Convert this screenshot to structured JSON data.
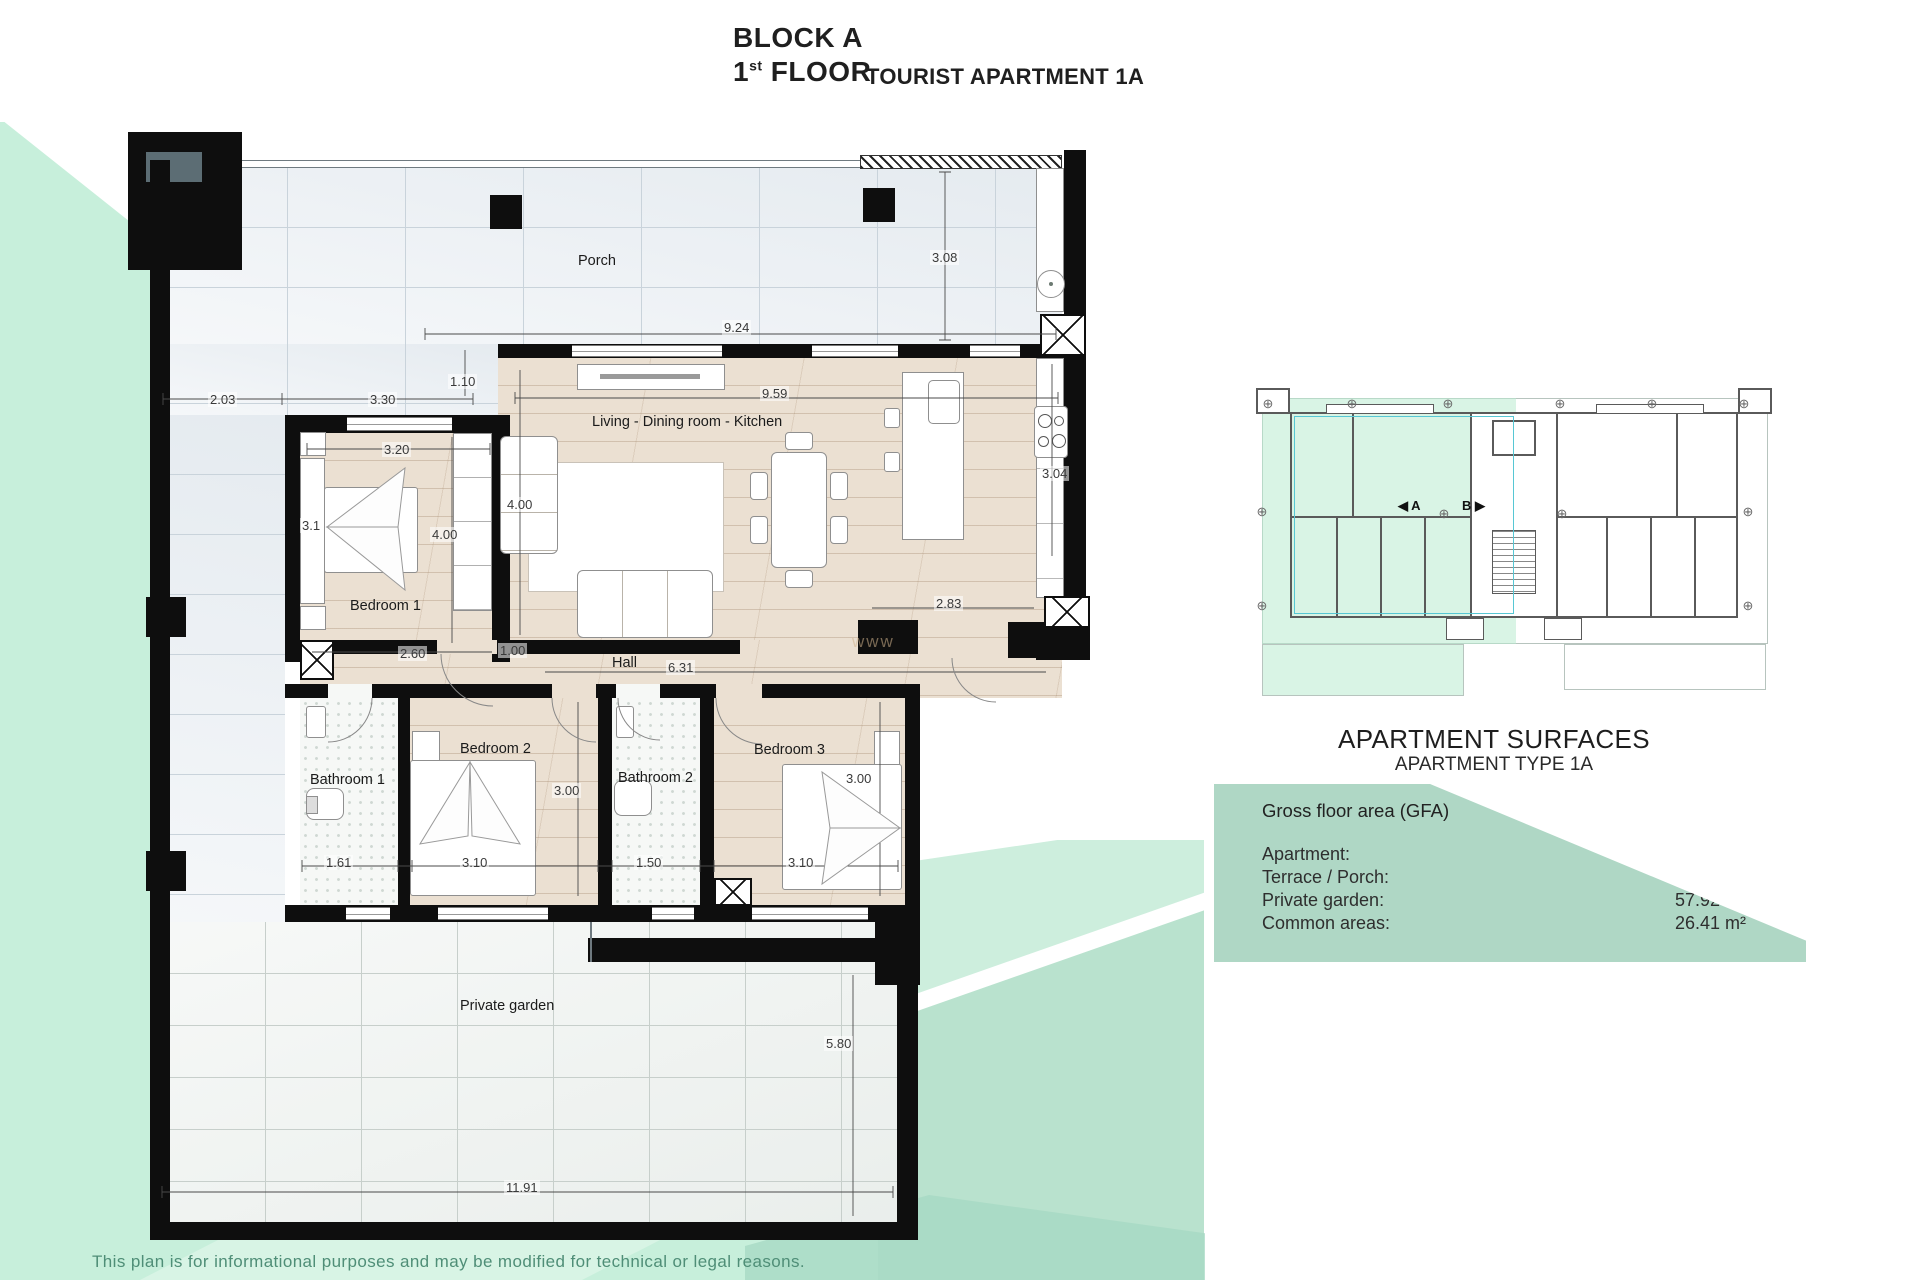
{
  "title": {
    "block": "BLOCK A",
    "floor_num": "1",
    "floor_sup": "st",
    "floor_word": " FLOOR",
    "apartment": "TOURIST APARTMENT 1A"
  },
  "surfaces": {
    "heading": "APARTMENT SURFACES",
    "subheading": "APARTMENT TYPE 1A",
    "table_title": "Gross floor area (GFA)",
    "rows": [
      {
        "label": "Apartment:",
        "value": "97.47 m²"
      },
      {
        "label": "Terrace / Porch:",
        "value": "86.84 m²"
      },
      {
        "label": "Private garden:",
        "value": "57.92 m²"
      },
      {
        "label": "Common areas:",
        "value": "26.41 m²"
      }
    ]
  },
  "mini_plan": {
    "unit_a_label": "◀ A",
    "unit_b_label": "B ▶",
    "marker_glyph": "⊕",
    "markers": [
      {
        "x": 1268,
        "y": 404
      },
      {
        "x": 1352,
        "y": 404
      },
      {
        "x": 1448,
        "y": 404
      },
      {
        "x": 1560,
        "y": 404
      },
      {
        "x": 1652,
        "y": 404
      },
      {
        "x": 1744,
        "y": 404
      },
      {
        "x": 1262,
        "y": 512
      },
      {
        "x": 1444,
        "y": 514
      },
      {
        "x": 1562,
        "y": 514
      },
      {
        "x": 1748,
        "y": 512
      },
      {
        "x": 1262,
        "y": 606
      },
      {
        "x": 1748,
        "y": 606
      }
    ]
  },
  "plan": {
    "room_labels": [
      {
        "text": "Porch",
        "x": 578,
        "y": 253
      },
      {
        "text": "Living - Dining room - Kitchen",
        "x": 592,
        "y": 414
      },
      {
        "text": "Bedroom 1",
        "x": 350,
        "y": 598
      },
      {
        "text": "Hall",
        "x": 612,
        "y": 655
      },
      {
        "text": "Bathroom 1",
        "x": 310,
        "y": 772
      },
      {
        "text": "Bedroom 2",
        "x": 460,
        "y": 741
      },
      {
        "text": "Bathroom 2",
        "x": 618,
        "y": 770
      },
      {
        "text": "Bedroom 3",
        "x": 754,
        "y": 742
      },
      {
        "text": "Private garden",
        "x": 460,
        "y": 998
      }
    ],
    "dimensions": [
      {
        "text": "2.03",
        "x": 208,
        "y": 392
      },
      {
        "text": "3.30",
        "x": 368,
        "y": 392
      },
      {
        "text": "1.10",
        "x": 448,
        "y": 374
      },
      {
        "text": "9.24",
        "x": 722,
        "y": 320
      },
      {
        "text": "3.08",
        "x": 930,
        "y": 250
      },
      {
        "text": "9.59",
        "x": 760,
        "y": 386
      },
      {
        "text": "4.00",
        "x": 505,
        "y": 497
      },
      {
        "text": "3.04",
        "x": 1040,
        "y": 466
      },
      {
        "text": "2.83",
        "x": 934,
        "y": 596
      },
      {
        "text": "3.20",
        "x": 382,
        "y": 442
      },
      {
        "text": "3.1",
        "x": 300,
        "y": 518
      },
      {
        "text": "4.00",
        "x": 430,
        "y": 527
      },
      {
        "text": "2.60",
        "x": 398,
        "y": 646
      },
      {
        "text": "1.00",
        "x": 498,
        "y": 643
      },
      {
        "text": "6.31",
        "x": 666,
        "y": 660
      },
      {
        "text": "1.61",
        "x": 324,
        "y": 855
      },
      {
        "text": "3.10",
        "x": 460,
        "y": 855
      },
      {
        "text": "3.00",
        "x": 552,
        "y": 783
      },
      {
        "text": "1.50",
        "x": 634,
        "y": 855
      },
      {
        "text": "3.00",
        "x": 844,
        "y": 771
      },
      {
        "text": "3.10",
        "x": 786,
        "y": 855
      },
      {
        "text": "5.80",
        "x": 824,
        "y": 1036
      },
      {
        "text": "11.91",
        "x": 504,
        "y": 1180
      }
    ],
    "watermark": "www"
  },
  "footer": {
    "disclaimer": "This plan is for informational purposes and may be modified for technical or legal reasons."
  },
  "colors": {
    "mint": "#c7efdb",
    "mint_block": "#b9e2ce",
    "mint_light": "#d8f4e5",
    "panel": "#afd7c5",
    "wall": "#0e0e0e",
    "accent_cyan": "#57c7d4"
  }
}
